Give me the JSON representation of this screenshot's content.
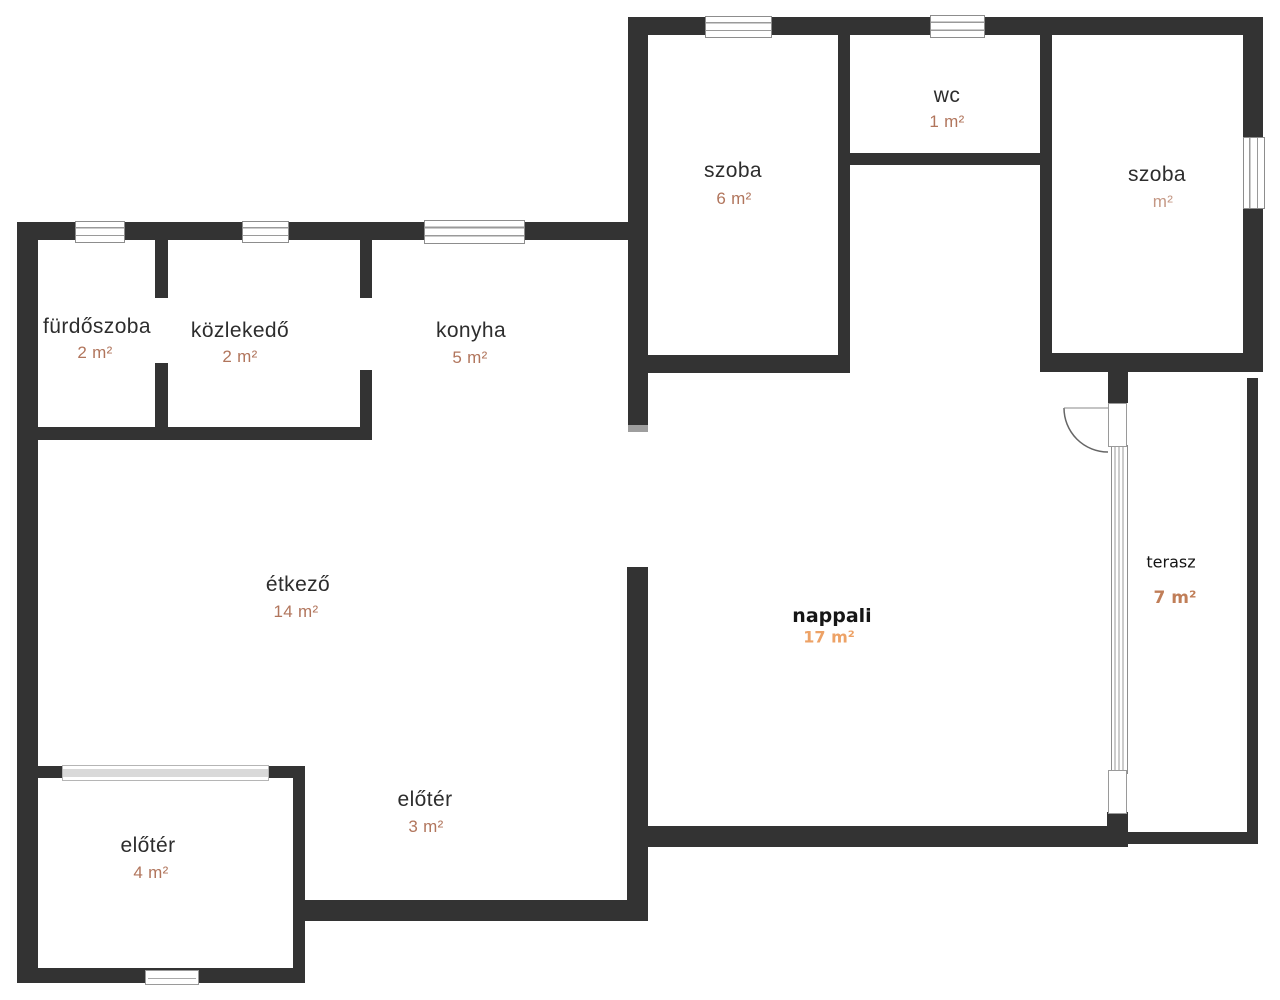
{
  "plan": {
    "title": "floor-plan",
    "rooms": [
      {
        "name": "fürdőszoba",
        "area": "2 m²"
      },
      {
        "name": "közlekedő",
        "area": "2 m²"
      },
      {
        "name": "konyha",
        "area": "5 m²"
      },
      {
        "name": "szoba",
        "area": "6 m²"
      },
      {
        "name": "wc",
        "area": "1 m²"
      },
      {
        "name": "szoba",
        "area": "m²"
      },
      {
        "name": "étkező",
        "area": "14 m²"
      },
      {
        "name": "nappali",
        "area": "17 m²"
      },
      {
        "name": "terasz",
        "area": "7 m²"
      },
      {
        "name": "előtér",
        "area": "3 m²"
      },
      {
        "name": "előtér",
        "area": "4 m²"
      }
    ],
    "colors": {
      "wall": "#333333",
      "label": "#2d2d2d",
      "area": "#b1755c",
      "nappali_area": "#eda266",
      "terasz_area": "#c07e58"
    }
  }
}
